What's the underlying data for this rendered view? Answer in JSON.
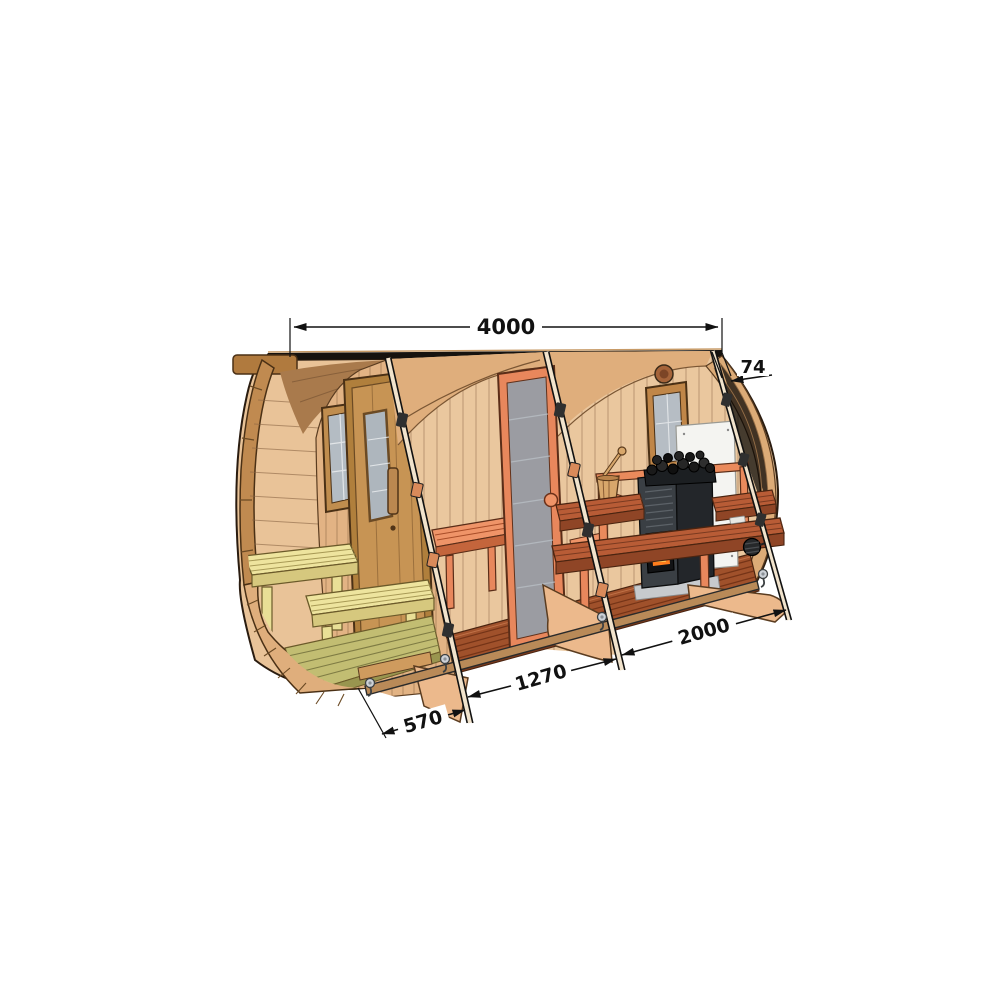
{
  "meta": {
    "type": "technical-illustration",
    "subject": "barrel sauna cutaway diagram with dimension annotations",
    "background": "#ffffff"
  },
  "dimensions": {
    "top": {
      "value": "4000"
    },
    "right": {
      "value": "74"
    },
    "bottom_right": {
      "value": "2000"
    },
    "bottom_middle": {
      "value": "1270"
    },
    "bottom_left": {
      "value": "570"
    }
  },
  "colors": {
    "wood_light": "#e9c398",
    "wood_shell": "#dfae7c",
    "wood_medium": "#cfa06a",
    "wood_dark_rim": "#b07a3e",
    "accent_terracotta": "#e8875c",
    "bench_redwood": "#b85c36",
    "floor_redwood": "#a0512b",
    "porch_bench_yellow": "#e9df96",
    "porch_deck_olive": "#c2bd72",
    "heater_body": "#3a3f44",
    "heater_stones": "#1a1a1a",
    "fire_glow": "#ff7d1d",
    "glass_gray": "#9aa1a8",
    "heat_shield_white": "#f4f4f1",
    "dimension_ink": "#111111"
  }
}
